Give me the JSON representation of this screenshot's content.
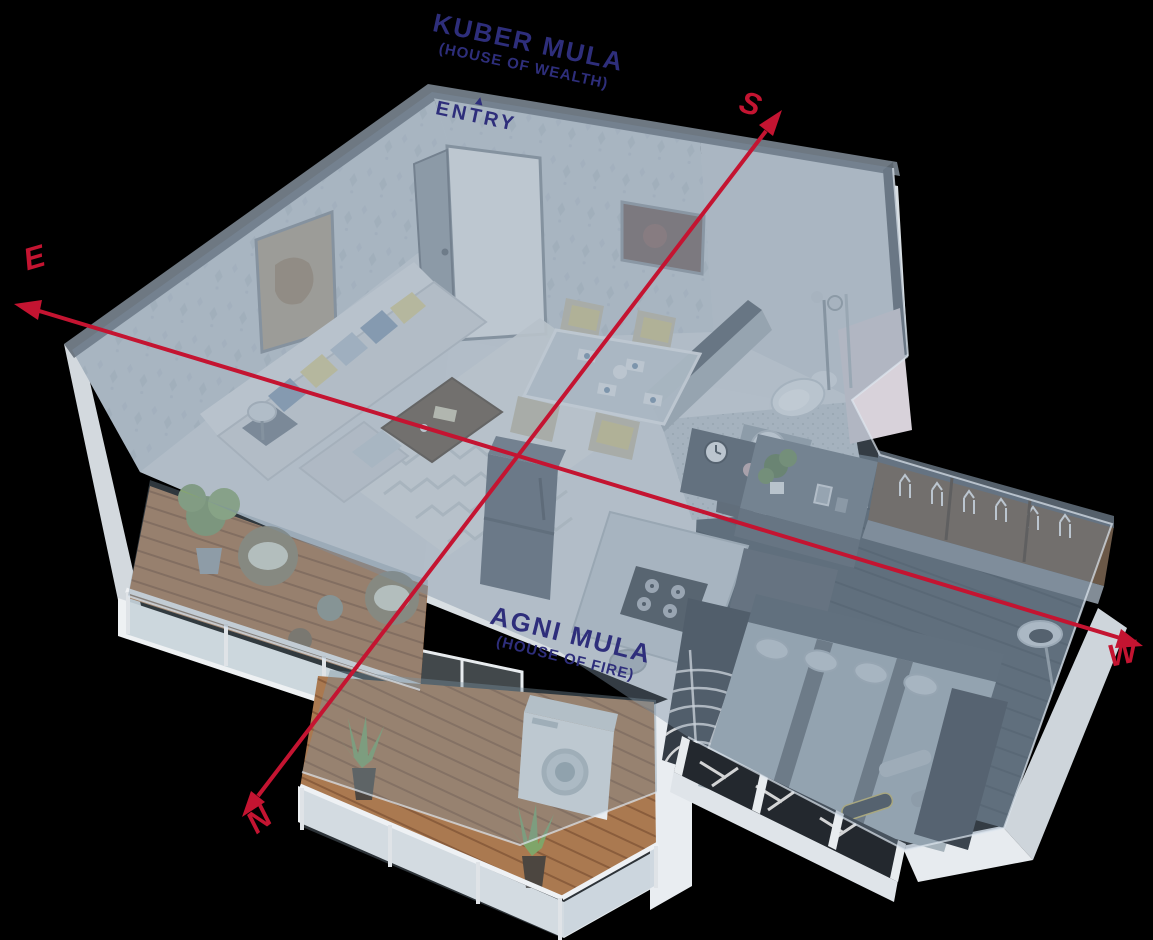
{
  "diagram": {
    "type": "vastu-3d-floor-plan",
    "labels": {
      "kuber_mula": {
        "title": "KUBER MULA",
        "subtitle": "(HOUSE OF WEALTH)"
      },
      "entry": {
        "text": "ENTRY",
        "arrow_icon": "▲"
      },
      "agni_mula": {
        "title": "AGNI MULA",
        "subtitle": "(HOUSE OF FIRE)"
      }
    },
    "compass": {
      "east": "E",
      "south": "S",
      "west": "W",
      "north": "N"
    },
    "colors": {
      "label_text": "#2e2e7b",
      "compass_line": "#c41431",
      "glass_tint": "#7b90a1",
      "deck_wood": "#a9764f",
      "wallpaper": "#c8d1d8",
      "dark_wood_floor": "#4d5862",
      "exterior_wall": "#e9edf1"
    }
  }
}
